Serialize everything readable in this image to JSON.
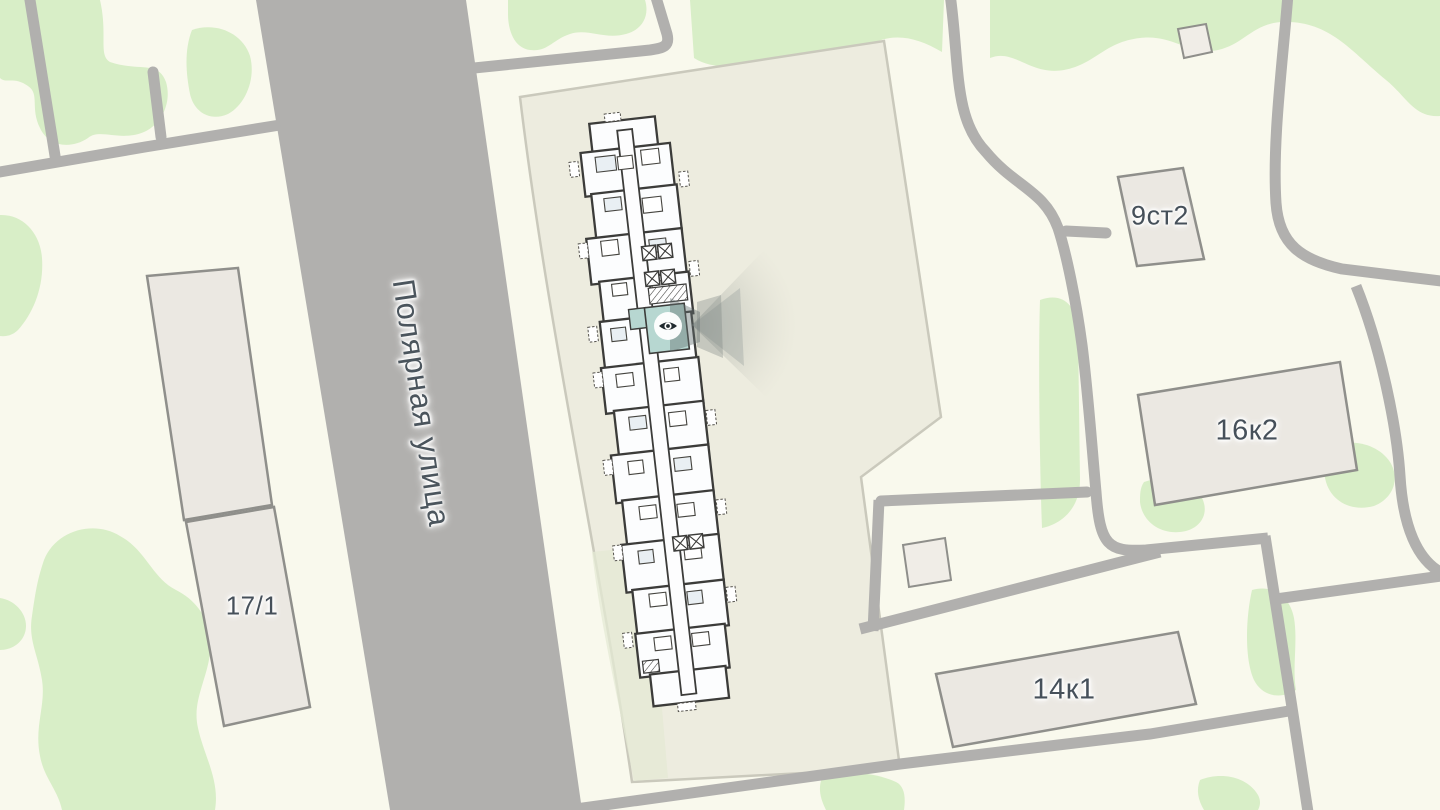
{
  "map": {
    "street": {
      "label": "Полярная улица"
    },
    "buildings": [
      {
        "label": "17/1"
      },
      {
        "label": "9ст2"
      },
      {
        "label": "16к2"
      },
      {
        "label": "14к1"
      }
    ],
    "marker": {
      "kind": "view-point",
      "icon": "eye-icon"
    },
    "colors": {
      "background": "#f9f9ed",
      "green": "#d8eec7",
      "road": "#b1b0ae",
      "parcel_fill": "#edecdf",
      "parcel_border": "#cac9bc",
      "building_fill": "#ebe8e2",
      "building_border": "#8f8f8b",
      "plan_wall": "#3c3c3a",
      "plan_room": "#fcfdfe",
      "selected_room": "#b7d7d1",
      "label_text": "#46505a"
    }
  }
}
